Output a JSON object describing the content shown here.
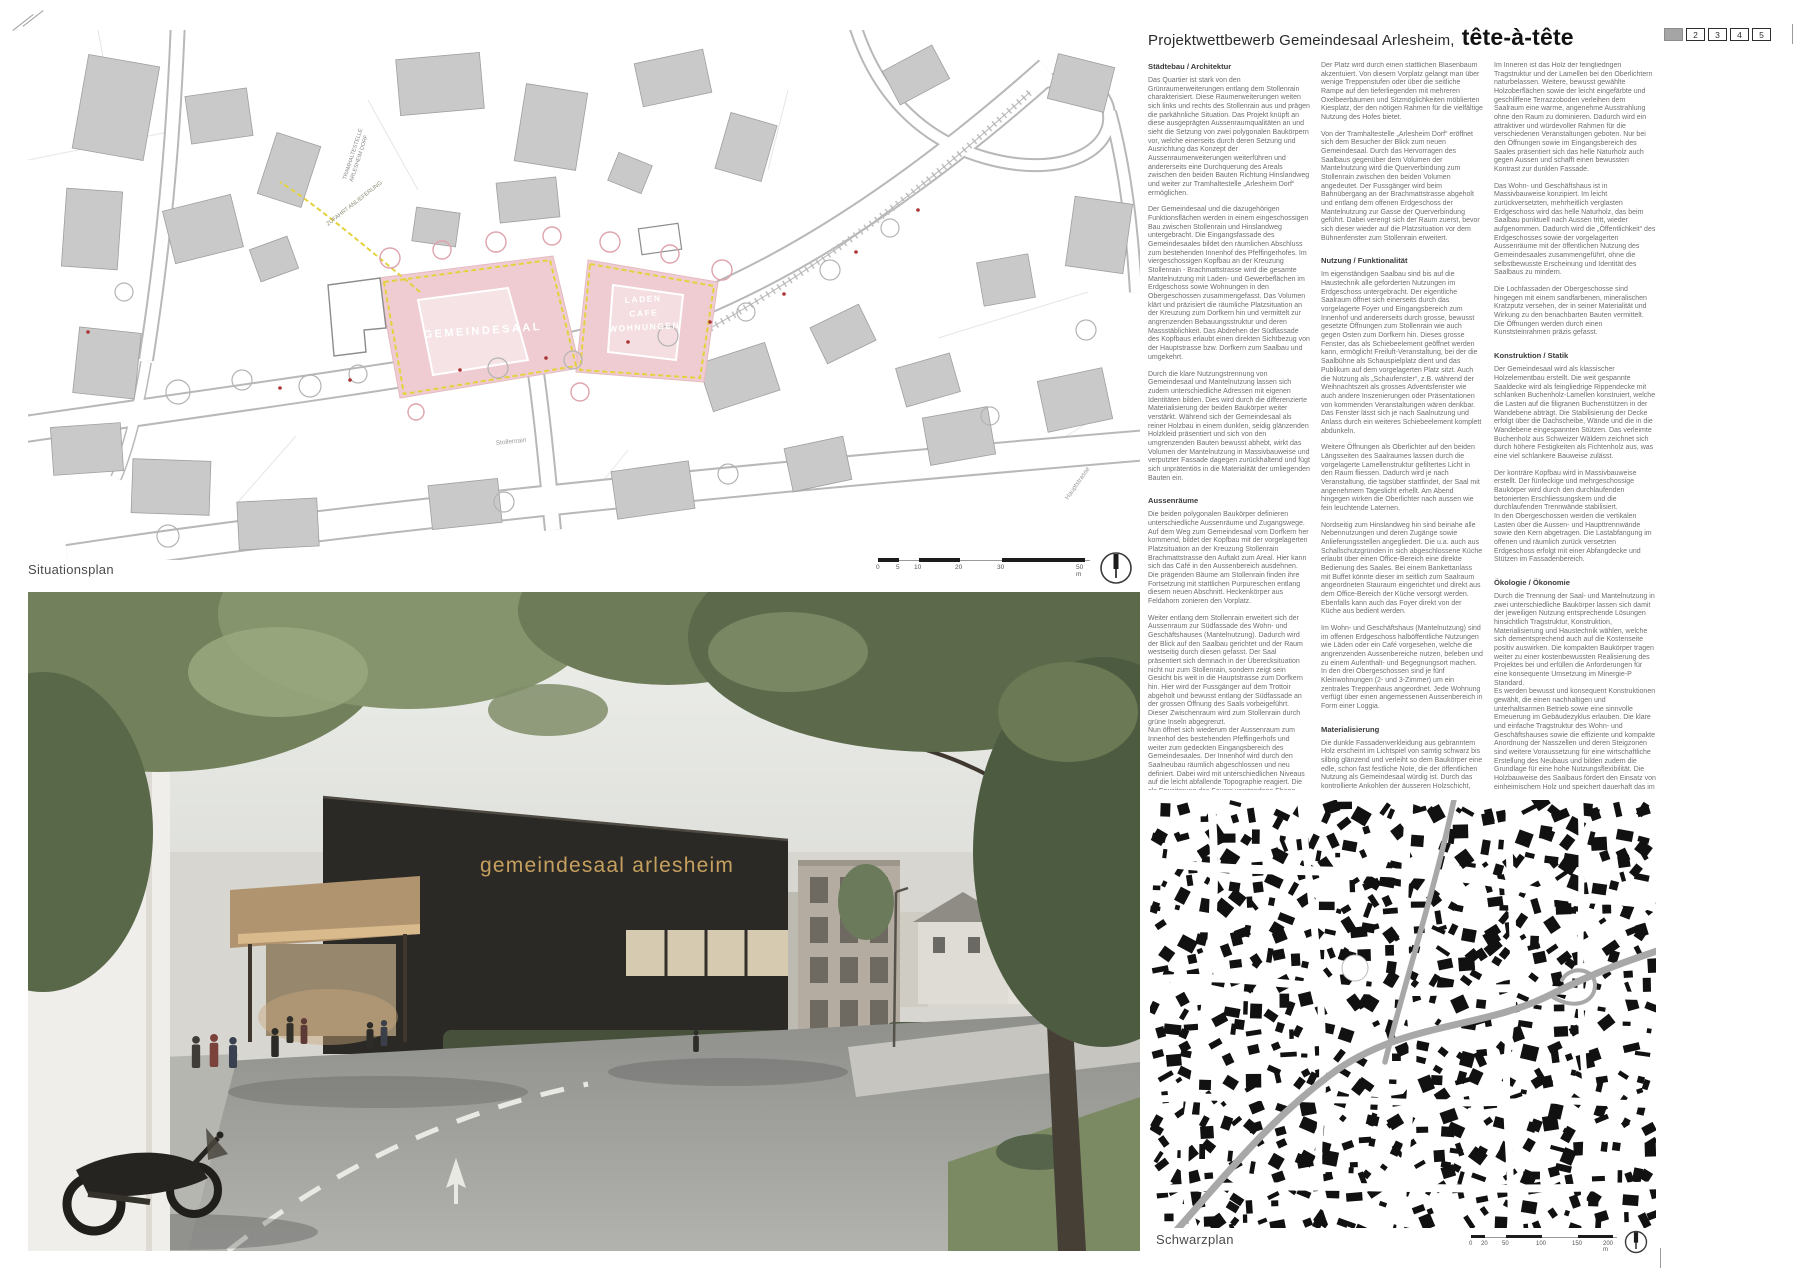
{
  "header": {
    "title_prefix": "Projektwettbewerb Gemeindesaal Arlesheim,",
    "title_name": "tête-à-tête",
    "page_tabs": [
      "2",
      "3",
      "4",
      "5"
    ]
  },
  "colors": {
    "site_pink": "#efccd2",
    "dash_yellow": "#e3d23e",
    "facade_gold": "#c6a05e",
    "tab_current_gray": "#a5a5a5"
  },
  "situationsplan": {
    "caption": "Situationsplan",
    "scale_ticks": [
      "0",
      "5",
      "10",
      "20",
      "30",
      "50 m"
    ],
    "plan_labels": {
      "site_main": "GEMEINDESAAL",
      "site_mixed": [
        "LADEN",
        "CAFE",
        "WOHNUNGEN"
      ],
      "delivery": "ZUFAHRT ANLIEFERUNG",
      "tram_stop": [
        "TRAMHALTESTELLE",
        "ARLESHEIM DORF"
      ],
      "street_1": "Stollenrain",
      "street_2": "Hauptstrasse"
    }
  },
  "rendering": {
    "facade_text": "gemeindesaal arlesheim"
  },
  "schwarzplan": {
    "caption": "Schwarzplan",
    "scale_ticks": [
      "0",
      "20",
      "50",
      "100",
      "150",
      "200 m"
    ]
  },
  "columns": [
    {
      "blocks": [
        {
          "t": "h",
          "text": "Städtebau / Architektur"
        },
        {
          "t": "p",
          "text": "Das Quartier ist stark von den Grünraumerweiterungen entlang dem Stollenrain charakterisiert. Diese Raumerweiterungen weiten sich links und rechts des Stollenrain aus und prägen die parkähnliche Situation. Das Projekt knüpft an diese ausgeprägten Aussenraumqualitäten an und sieht die Setzung von zwei polygonalen Baukörpern vor, welche einerseits durch deren Setzung und Ausrichtung das Konzept der Aussenraumerweiterungen weiterführen und andererseits eine Durchquerung des Areals zwischen den beiden Bauten Richtung Hinslandweg und weiter zur Tramhaltestelle „Arlesheim Dorf“ ermöglichen."
        },
        {
          "t": "p",
          "text": "Der Gemeindesaal und die dazugehörigen Funktionsflächen werden in einem eingeschossigen Bau zwischen Stollenrain und Hinslandweg untergebracht. Die Eingangsfassade des Gemeindesaales bildet den räumlichen Abschluss zum bestehenden Innenhof des Pfeffingerhofes. Im viergeschossigen Kopfbau an der Kreuzung Stollenrain - Brachmattstrasse wird die gesamte Mantelnutzung mit Laden- und Gewerbeflächen im Erdgeschoss sowie Wohnungen in den Obergeschossen zusammengefasst. Das Volumen klärt und präzisiert die räumliche Platzsituation an der Kreuzung zum Dorfkern hin und vermittelt zur angrenzenden Bebauungsstruktur und deren Massstäblichkeit. Das Abdrehen der Südfassade des Kopfbaus erlaubt einen direkten Sichtbezug von der Hauptstrasse bzw. Dorfkern zum Saalbau und umgekehrt."
        },
        {
          "t": "p",
          "text": "Durch die klare Nutzungstrennung von Gemeindesaal und Mantelnutzung lassen sich zudem unterschiedliche Adressen mit eigenen Identitäten bilden. Dies wird durch die differenzierte Materialisierung der beiden Baukörper weiter verstärkt. Während sich der Gemeindesaal als reiner Holzbau in einem dunklen, seidig glänzenden Holzkleid präsentiert und sich von den umgrenzenden Bauten bewusst abhebt, wirkt das Volumen der Mantelnutzung in Massivbauweise und verputzter Fassade dagegen zurückhaltend und fügt sich unprätentiös in die Materialität der umliegenden Bauten ein."
        },
        {
          "t": "h",
          "text": "Aussenräume"
        },
        {
          "t": "p",
          "text": "Die beiden polygonalen Baukörper definieren unterschiedliche Aussenräume und Zugangswege. Auf dem Weg zum Gemeindesaal vom Dorfkern her kommend, bildet der Kopfbau mit der vorgelagerten Platzsituation an der Kreuzung Stollenrain Brachmattstrasse den Auftakt zum Areal. Hier kann sich das Café in den Aussenbereich ausdehnen. Die prägenden Bäume am Stollenrain finden ihre Fortsetzung mit stattlichen Purpureschen entlang diesem neuen Abschnitt. Heckenkörper aus Feldahorn zonieren den Vorplatz."
        },
        {
          "t": "p",
          "text": "Weiter entlang dem Stollenrain erweitert sich der Aussenraum zur Südfassade des Wohn- und Geschäftshauses (Mantelnutzung). Dadurch wird der Blick auf den Saalbau gerichtet und der Raum westseitig durch diesen gefasst. Der Saal präsentiert sich demnach in der Überecksituation nicht nur zum Stollenrain, sondern zeigt sein Gesicht bis weit in die Hauptstrasse zum Dorfkern hin. Hier wird der Fussgänger auf dem Trottoir abgeholt und bewusst entlang der Südfassade an der grossen Öffnung des Saals vorbeigeführt. Dieser Zwischenraum wird zum Stollenrain durch grüne Inseln abgegrenzt."
        },
        {
          "t": "pt",
          "text": "Nun öffnet sich wiederum der Aussenraum zum Innenhof des bestehenden Pfeffingerhofs und weiter zum gedeckten Eingangsbereich des Gemeindesaales. Der Innenhof wird durch den Saalneubau räumlich abgeschlossen und neu definiert. Dabei wird mit unterschiedlichen Niveaus auf die leicht abfallende Topographie reagiert. Die als Erweiterung des Foyers verstandene Ebene beim Haupteingang des Saals ragt als leicht erhöhte Terrasse in den Innenhof hinein und schliesst mit einer Sitzmauer diesen Bereich ab."
        }
      ]
    },
    {
      "blocks": [
        {
          "t": "p",
          "text": "Der Platz wird durch einen stattlichen Blasenbaum akzentuiert. Von diesem Vorplatz gelangt man über wenige Treppenstufen oder über die seitliche Rampe auf den tieferliegenden mit mehreren Oxelbeerbäumen und Sitzmöglichkeiten möblierten Kiesplatz, der den nötigen Rahmen für die vielfältige Nutzung des Hofes bietet."
        },
        {
          "t": "p",
          "text": "Von der Tramhaltestelle „Arlesheim Dorf“ eröffnet sich dem Besucher der Blick zum neuen Gemeindesaal. Durch das Hervorragen des Saalbaus gegenüber dem Volumen der Mantelnutzung wird die Querverbindung zum Stollenrain zwischen den beiden Volumen angedeutet. Der Fussgänger wird beim Bahnübergang an der Brachmattstrasse abgeholt und entlang dem offenen Erdgeschoss der Mantelnutzung zur Gasse der Querverbindung geführt. Dabei verengt sich der Raum zuerst, bevor sich dieser wieder auf die Platzsituation vor dem Bühnenfenster zum Stollenrain erweitert."
        },
        {
          "t": "h",
          "text": "Nutzung / Funktionalität"
        },
        {
          "t": "p",
          "text": "Im eigenständigen Saalbau sind bis auf die Haustechnik alle geforderten Nutzungen im Erdgeschoss untergebracht. Der eigentliche Saalraum öffnet sich einerseits durch das vorgelagerte Foyer und Eingangsbereich zum Innenhof und andererseits durch grosse, bewusst gesetzte Öffnungen zum Stollenrain wie auch gegen Osten zum Dorfkern hin. Dieses grosse Fenster, das als Schiebeelement geöffnet werden kann, ermöglicht Freiluft-Veranstaltung, bei der die Saalbühne als Schauspielplatz dient und das Publikum auf dem vorgelagerten Platz sitzt. Auch die Nutzung als „Schaufenster“, z.B. während der Weihnachtszeit als grosses Adventsfenster wie auch andere Inszenierungen oder Präsentationen von kommenden Veranstaltungen wären denkbar. Das Fenster lässt sich je nach Saalnutzung und Anlass durch ein weiteres Schiebeelement komplett abdunkeln."
        },
        {
          "t": "p",
          "text": "Weitere Öffnungen als Oberlichter auf den beiden Längsseiten des Saalraumes lassen durch die vorgelagerte Lamellenstruktur gefiltertes Licht in den Raum fliessen. Dadurch wird je nach Veranstaltung, die tagsüber stattfindet, der Saal mit angenehmem Tageslicht erhellt. Am Abend hingegen wirken die Oberlichter nach aussen wie fein leuchtende Laternen."
        },
        {
          "t": "p",
          "text": "Nordseitig zum Hinslandweg hin sind beinahe alle Nebennutzungen und deren Zugänge sowie Anlieferungsstellen angegliedert. Die u.a. auch aus Schallschutzgründen in sich abgeschlossene Küche erlaubt über einen Office-Bereich eine direkte Bedienung des Saales. Bei einem Bankettanlass mit Buffet könnte dieser im seitlich zum Saalraum angeordneten Stauraum eingerichtet und direkt aus dem Office-Bereich der Küche versorgt werden. Ebenfalls kann auch das Foyer direkt von der Küche aus bedient werden."
        },
        {
          "t": "p",
          "text": "Im Wohn- und Geschäftshaus (Mantelnutzung) sind im offenen Erdgeschoss halböffentliche Nutzungen wie Läden oder ein Café vorgesehen, welche die angrenzenden Aussenbereiche nutzen, beleben und zu einem Aufenthalt- und Begegnungsort machen. In den drei Obergeschossen sind je fünf Kleinwohnungen (2- und 3-Zimmer) um ein zentrales Treppenhaus angeordnet. Jede Wohnung verfügt über einen angemessenen Aussenbereich in Form einer Loggia."
        },
        {
          "t": "h",
          "text": "Materialisierung"
        },
        {
          "t": "p",
          "text": "Die dunkle Fassadenverkleidung aus gebranntem Holz erscheint im Lichtspiel von samtig schwarz bis silbrig glänzend und verleiht so dem Baukörper eine edle, schon fast festliche Note, die der öffentlichen Nutzung als Gemeindesaal würdig ist. Durch das kontrollierte Ankohlen der äusseren Holzschicht, eine alte Technik der Materialbehandlung, entsteht zudem eine natürliche Schutzschicht, die das edle Holzkleid vor Schädlingen und der Witterung schützt."
        }
      ]
    },
    {
      "blocks": [
        {
          "t": "p",
          "text": "Im Inneren ist das Holz der feingliedrigen Tragstruktur und der Lamellen bei den Oberlichtern naturbelassen. Weitere, bewusst gewählte Holzoberflächen sowie der leicht eingefärbte und geschliffene Terrazzoboden verleihen dem Saalraum eine warme, angenehme Ausstrahlung ohne den Raum zu dominieren. Dadurch wird ein attraktiver und würdevoller Rahmen für die verschiedenen Veranstaltungen geboten. Nur bei den Öffnungen sowie im Eingangsbereich des Saales präsentiert sich das helle Naturholz auch gegen Aussen und schafft einen bewussten Kontrast zur dunklen Fassade."
        },
        {
          "t": "p",
          "text": "Das Wohn- und Geschäftshaus ist in Massivbauweise konzipiert. Im leicht zurückversetzten, mehrheitlich verglasten Erdgeschoss wird das helle Naturholz, das beim Saalbau punktuell nach Aussen tritt, wieder aufgenommen. Dadurch wird die „Öffentlichkeit“ des Erdgeschosses sowie der vorgelagerten Aussenräume mit der öffentlichen Nutzung des Gemeindesaales zusammengeführt, ohne die selbstbewusste Erscheinung und Identität des Saalbaus zu mindern."
        },
        {
          "t": "p",
          "text": "Die Lochfassaden der Obergeschosse sind hingegen mit einem sandfarbenen, mineralischen Kratzputz versehen, der in seiner Materialität und Wirkung zu den benachbarten Bauten vermittelt. Die Öffnungen werden durch einen Kunststeinrahmen präzis gefasst."
        },
        {
          "t": "h",
          "text": "Konstruktion / Statik"
        },
        {
          "t": "p",
          "text": "Der Gemeindesaal wird als klassischer Holzelementbau erstellt. Die weit gespannte Saaldecke wird als feingliedrige Rippendecke mit schlanken Buchenholz-Lamellen konstruiert, welche die Lasten auf die filigranen Buchenstützen in der Wandebene abträgt. Die Stabilisierung der Decke erfolgt über die Dachscheibe, Wände und die in die Wandebene eingespannten Stützen. Das verleimte Buchenholz aus Schweizer Wäldern zeichnet sich durch höhere Festigkeiten als Fichtenholz aus, was eine viel schlankere Bauweise zulässt."
        },
        {
          "t": "p",
          "text": "Der konträre Kopfbau wird in Massivbauweise erstellt. Der fünfeckige und mehrgeschossige Baukörper wird durch den durchlaufenden betonierten Erschliessungskern und die durchlaufenden Trennwände stabilisiert."
        },
        {
          "t": "pt",
          "text": "In den Obergeschossen werden die vertikalen Lasten über die Aussen- und Haupttrennwände sowie den Kern abgetragen. Die Lastabfangung im offenen und räumlich zurück versetzten Erdgeschoss erfolgt mit einer Abfangdecke und Stützen im Fassadenbereich."
        },
        {
          "t": "h",
          "text": "Ökologie / Ökonomie"
        },
        {
          "t": "p",
          "text": "Durch die Trennung der Saal- und Mantelnutzung in zwei unterschiedliche Baukörper lassen sich damit der jeweiligen Nutzung entsprechende Lösungen hinsichtlich Tragstruktur, Konstruktion, Materialisierung und Haustechnik wählen, welche sich dementsprechend auch auf die Kostenseite positiv auswirken. Die kompakten Baukörper tragen weiter zu einer kostenbewussten Realisierung des Projektes bei und erfüllen die Anforderungen für eine konsequente Umsetzung im Minergie-P Standard."
        },
        {
          "t": "pt",
          "text": "Es werden bewusst und konsequent Konstruktionen gewählt, die einen nachhaltigen und unterhaltsarmen Betrieb sowie eine sinnvolle Erneuerung im Gebäudezyklus erlauben. Die klare und einfache Tragstruktur des Wohn- und Geschäftshauses sowie die effiziente und kompakte Anordnung der Nasszellen und deren Steigzonen sind weitere Voraussetzung für eine wirtschaftliche Erstellung des Neubaus und bilden zudem die Grundlage für eine hohe Nutzungsflexibilität. Die Holzbauweise des Saalbaus fördert den Einsatz von einheimischem Holz und speichert dauerhaft das im Holz gebundene Kohlendioxid CO2, was sich wiederum positiv und nachhaltig auf unsere Umwelt auswirkt."
        }
      ]
    }
  ]
}
